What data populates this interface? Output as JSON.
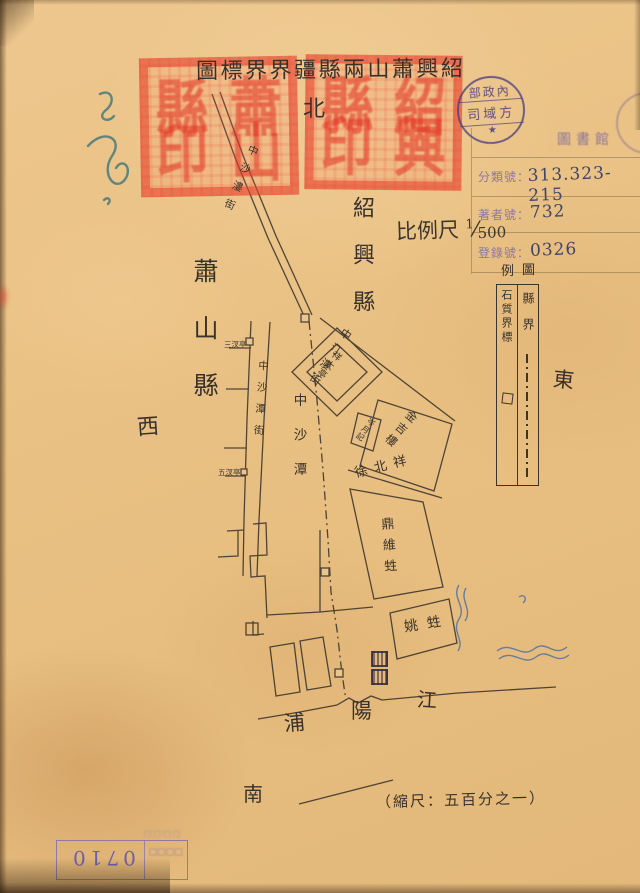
{
  "title": {
    "display": "圖標界界疆縣兩山蕭興紹"
  },
  "compass": {
    "north": "北",
    "south": "南",
    "east": "東",
    "west": "西"
  },
  "regions": {
    "west_county": "蕭山縣",
    "east_county": "紹興縣"
  },
  "scale": {
    "label": "比例尺",
    "numerator": "1",
    "slash": "⁄",
    "denominator": "500",
    "printed_note": "（縮尺：五百分之一）"
  },
  "legend": {
    "title_left": "例",
    "title_right": "圖",
    "county_boundary": "縣界",
    "stone_marker": "石質界標"
  },
  "library_label": {
    "header": "圖書館",
    "rows": [
      {
        "name": "分類號：",
        "value": "313.323-215"
      },
      {
        "name": "著者號：",
        "value": "732"
      },
      {
        "name": "登錄號：",
        "value": "0326"
      }
    ]
  },
  "round_stamp": {
    "row1": "部政內",
    "row2": "司域方",
    "row3": "★"
  },
  "seals": {
    "left": "蕭山縣印",
    "right": "紹興縣印"
  },
  "map_labels": {
    "street_top": "中沙漊街",
    "street_mid": "中汀漊街",
    "road_left": "中沙潭街",
    "boundary_road": "中沙潭",
    "pavilion": "祥太亭",
    "building_jin": "金吉樓",
    "shop_small": "岑月記",
    "name_xu": "徐北祥",
    "shop_ding": "鼎維甡",
    "shop_yao": "姚甡",
    "note_top": "三汊亭",
    "note_bottom": "五汊亭",
    "river": [
      "浦",
      "陽",
      "江"
    ]
  },
  "bottom_stamp": {
    "number": "0710",
    "illegible": "□□□□"
  }
}
